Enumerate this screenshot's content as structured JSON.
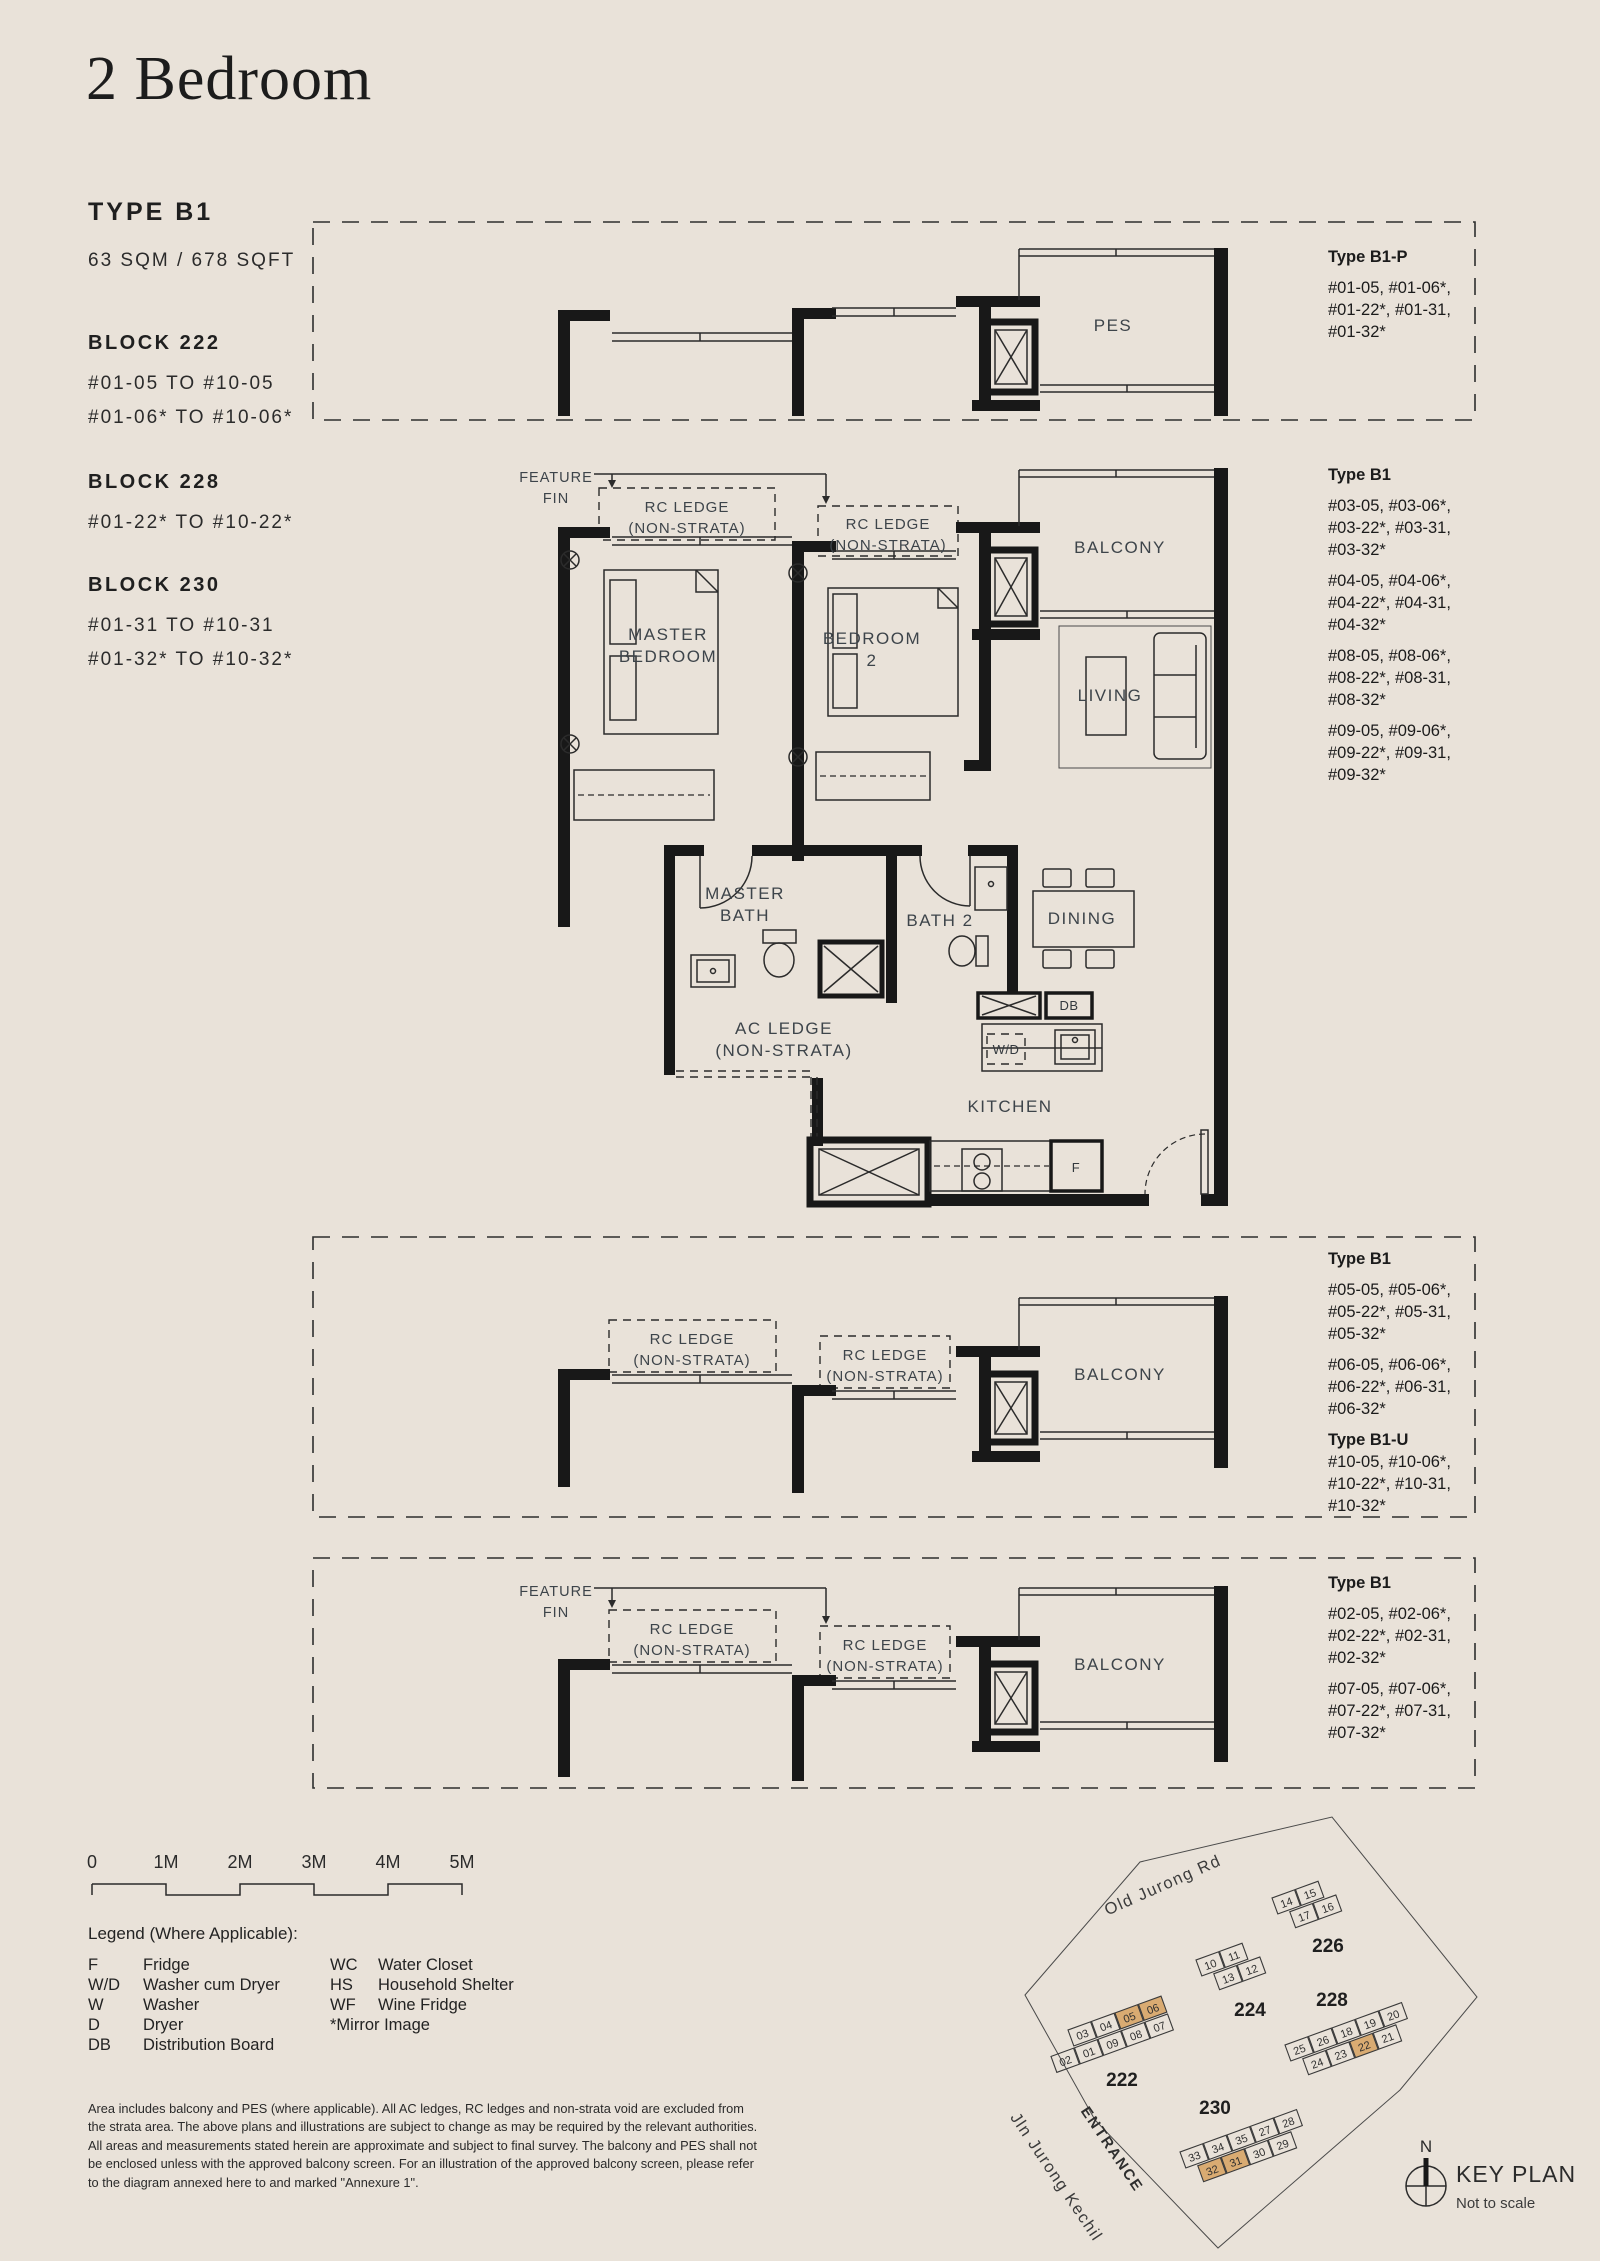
{
  "header": {
    "title": "2 Bedroom",
    "type": "TYPE B1",
    "area": "63 SQM / 678 SQFT"
  },
  "blocks": [
    {
      "name": "BLOCK 222",
      "units": [
        "#01-05 TO #10-05",
        "#01-06* TO #10-06*"
      ]
    },
    {
      "name": "BLOCK 228",
      "units": [
        "#01-22* TO #10-22*"
      ]
    },
    {
      "name": "BLOCK 230",
      "units": [
        "#01-31 TO #10-31",
        "#01-32* TO #10-32*"
      ]
    }
  ],
  "annotations": {
    "top": {
      "heading": "Type B1-P",
      "groups": [
        [
          "#01-05, #01-06*,",
          "#01-22*, #01-31,",
          "#01-32*"
        ]
      ]
    },
    "main": {
      "heading": "Type B1",
      "groups": [
        [
          "#03-05, #03-06*,",
          "#03-22*, #03-31,",
          "#03-32*"
        ],
        [
          "#04-05, #04-06*,",
          "#04-22*, #04-31,",
          "#04-32*"
        ],
        [
          "#08-05, #08-06*,",
          "#08-22*, #08-31,",
          "#08-32*"
        ],
        [
          "#09-05, #09-06*,",
          "#09-22*, #09-31,",
          "#09-32*"
        ]
      ]
    },
    "mid": {
      "heading": "Type B1",
      "groups": [
        [
          "#05-05, #05-06*,",
          "#05-22*, #05-31,",
          "#05-32*"
        ],
        [
          "#06-05, #06-06*,",
          "#06-22*, #06-31,",
          "#06-32*"
        ]
      ],
      "heading2": "Type B1-U",
      "groups2": [
        [
          "#10-05, #10-06*,",
          "#10-22*, #10-31,",
          "#10-32*"
        ]
      ]
    },
    "bottom": {
      "heading": "Type B1",
      "groups": [
        [
          "#02-05, #02-06*,",
          "#02-22*, #02-31,",
          "#02-32*"
        ],
        [
          "#07-05, #07-06*,",
          "#07-22*, #07-31,",
          "#07-32*"
        ]
      ]
    }
  },
  "plan_labels": {
    "feature_fin_1": "FEATURE",
    "feature_fin_2": "FIN",
    "rc_ledge_1": "RC LEDGE",
    "rc_ledge_2": "(NON-STRATA)",
    "ac_ledge_1": "AC LEDGE",
    "ac_ledge_2": "(NON-STRATA)",
    "master_bedroom_1": "MASTER",
    "master_bedroom_2": "BEDROOM",
    "bedroom2_1": "BEDROOM",
    "bedroom2_2": "2",
    "master_bath_1": "MASTER",
    "master_bath_2": "BATH",
    "bath2": "BATH 2",
    "balcony": "BALCONY",
    "living": "LIVING",
    "dining": "DINING",
    "kitchen": "KITCHEN",
    "pes": "PES",
    "db": "DB",
    "wd": "W/D",
    "fridge": "F"
  },
  "scale_bar": {
    "ticks": [
      "0",
      "1M",
      "2M",
      "3M",
      "4M",
      "5M"
    ]
  },
  "legend": {
    "heading": "Legend (Where Applicable):",
    "left": [
      {
        "abbr": "F",
        "desc": "Fridge"
      },
      {
        "abbr": "W/D",
        "desc": "Washer cum Dryer"
      },
      {
        "abbr": "W",
        "desc": "Washer"
      },
      {
        "abbr": "D",
        "desc": "Dryer"
      },
      {
        "abbr": "DB",
        "desc": "Distribution Board"
      }
    ],
    "right": [
      {
        "abbr": "WC",
        "desc": "Water Closet"
      },
      {
        "abbr": "HS",
        "desc": "Household Shelter"
      },
      {
        "abbr": "WF",
        "desc": "Wine Fridge"
      }
    ],
    "note": "*Mirror Image"
  },
  "disclaimer": [
    "Area includes balcony and PES (where applicable). All AC ledges, RC ledges and non-strata void are excluded from",
    "the strata area. The above plans and illustrations are subject to change as may be required by the relevant authorities.",
    "All areas and measurements stated herein are approximate and subject to final survey. The balcony and PES shall not",
    "be enclosed unless with the approved balcony screen. For an illustration of the approved balcony screen, please refer",
    "to the diagram annexed here to and marked \"Annexure 1\"."
  ],
  "key_plan": {
    "title": "KEY PLAN",
    "scale_note": "Not to scale",
    "north": "N",
    "road_top": "Old Jurong Rd",
    "road_left": "Jln Jurong Kechil",
    "entrance": "ENTRANCE",
    "highlight_color": "#d9ab72",
    "b222": {
      "label": "222",
      "row1": [
        "03",
        "04",
        "05",
        "06"
      ],
      "row2": [
        "02",
        "01",
        "09",
        "08",
        "07"
      ]
    },
    "b224": {
      "label": "224",
      "row1": [
        "10",
        "11"
      ],
      "row2": [
        "13",
        "12"
      ]
    },
    "b226": {
      "label": "226",
      "row1": [
        "14",
        "15"
      ],
      "row2": [
        "17",
        "16"
      ]
    },
    "b228": {
      "label": "228",
      "row1": [
        "25",
        "26",
        "18",
        "19",
        "20"
      ],
      "row2": [
        "24",
        "23",
        "22",
        "21"
      ]
    },
    "b230": {
      "label": "230",
      "row1": [
        "33",
        "34",
        "35",
        "27",
        "28"
      ],
      "row2": [
        "32",
        "31",
        "30",
        "29"
      ]
    }
  }
}
